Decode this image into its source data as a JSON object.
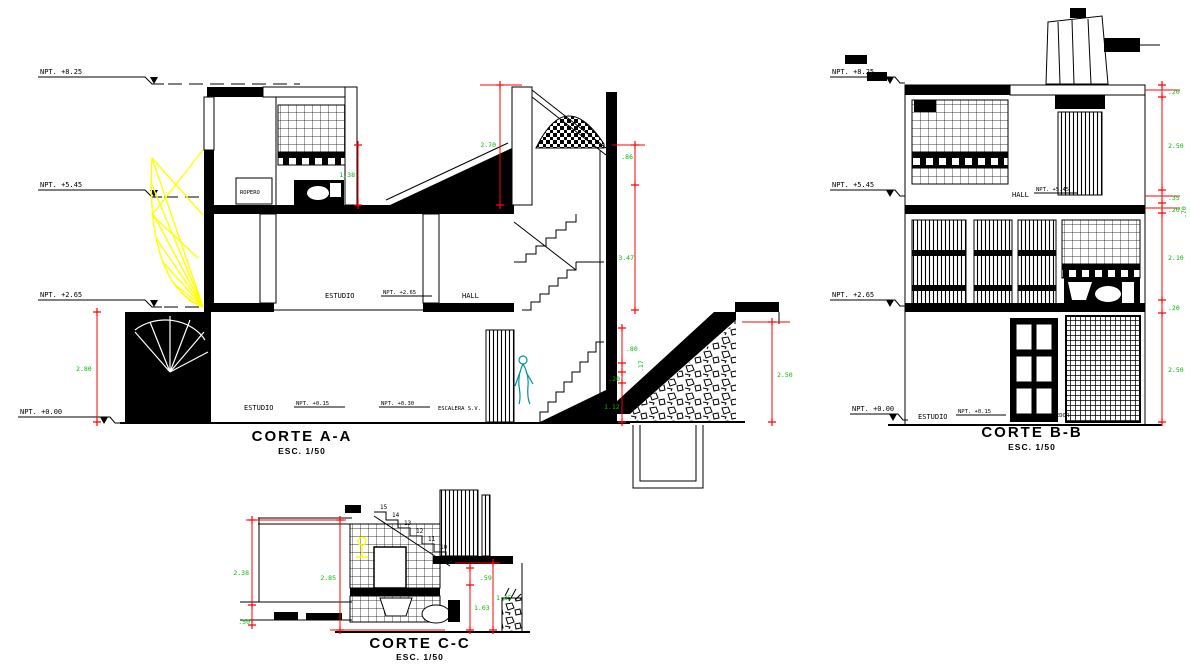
{
  "drawing": {
    "background": "#ffffff",
    "colors": {
      "line": "#000000",
      "dim_line": "#ff0000",
      "dim_text": "#00BB00",
      "stair_highlight": "#ffff00",
      "figure": "#00919E"
    },
    "corte_a": {
      "title": "CORTE A-A",
      "scale": "ESC. 1/50",
      "levels": [
        "NPT. +8.25",
        "NPT. +5.45",
        "NPT. +2.65",
        "NPT. +0.00"
      ],
      "rooms": {
        "ropero": "ROPERO",
        "estudio_2": "ESTUDIO",
        "npt_2": "NPT. +2.65",
        "hall": "HALL",
        "estudio_1": "ESTUDIO",
        "npt_015": "NPT. +0.15",
        "npt_030": "NPT. +0.30",
        "escalera": "ESCALERA S.V."
      },
      "dims": {
        "h_270": "2.70",
        "h_138": "1.38",
        "h_86": ".86",
        "h_347": "3.47",
        "h_80": ".80",
        "h_17": ".17",
        "h_20": ".20",
        "h_112": "1.12",
        "h_250": "2.50",
        "h_280": "2.80"
      }
    },
    "corte_b": {
      "title": "CORTE B-B",
      "scale": "ESC. 1/50",
      "levels": [
        "NPT. +8.25",
        "NPT. +5.45",
        "NPT. +2.65",
        "NPT. +0.00"
      ],
      "rooms": {
        "hall": "HALL",
        "npt_hall": "NPT. +5.45",
        "estudio": "ESTUDIO",
        "npt_015": "NPT. +0.15",
        "comedor": "COMEDOR"
      },
      "dims": {
        "d1": ".20",
        "d2": "2.50",
        "d3": ".35",
        "d4": ".20",
        "d5": ".70",
        "d6": "2.10",
        "d7": ".20",
        "d8": "2.50"
      }
    },
    "corte_c": {
      "title": "CORTE C-C",
      "scale": "ESC. 1/50",
      "dims": {
        "d1": "2.38",
        "d2": ".50",
        "d3": "2.85",
        "d4": ".59",
        "d5": "1.03",
        "d6": "1.35"
      },
      "steps": [
        "15",
        "14",
        "13",
        "12",
        "11",
        "10"
      ]
    }
  }
}
